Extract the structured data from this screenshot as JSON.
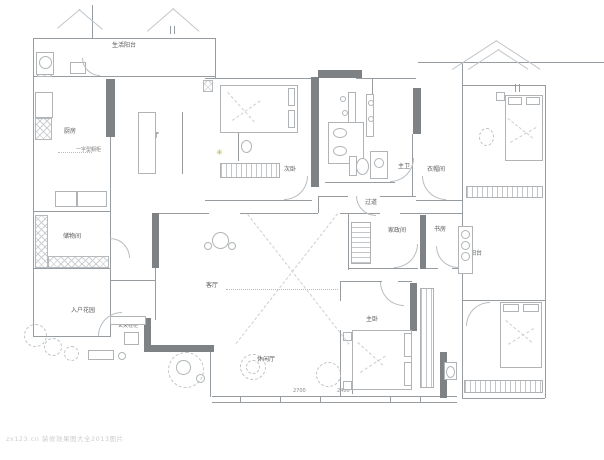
{
  "figure": {
    "type": "apartment-floor-plan"
  },
  "rooms": [
    {
      "label": "生活阳台"
    },
    {
      "label": "厨房"
    },
    {
      "label": "餐厅"
    },
    {
      "label": "次卧"
    },
    {
      "label": "主卫"
    },
    {
      "label": "衣帽间"
    },
    {
      "label": "过道"
    },
    {
      "label": "家政间"
    },
    {
      "label": "书房"
    },
    {
      "label": "阳台"
    },
    {
      "label": "储物间"
    },
    {
      "label": "客厅"
    },
    {
      "label": "入户花园"
    },
    {
      "label": "休闲厅"
    },
    {
      "label": "主卧"
    }
  ],
  "annotations": {
    "kitchen_cabinet": "一字型橱柜",
    "entry_cabinet": "玄关鞋柜",
    "window_dim_left": "2700",
    "window_dim_right": "2400"
  },
  "watermark": "zx123.cn 装修效果图大全2013图片",
  "icons": {
    "flower": "✳"
  },
  "colors": {
    "wall_fill": "#7e8284",
    "wall_line": "#979ca0",
    "hatch_line": "#c2c6c8",
    "flower_accent": "#b2aa3c",
    "label_text": "#5a5a5a"
  }
}
